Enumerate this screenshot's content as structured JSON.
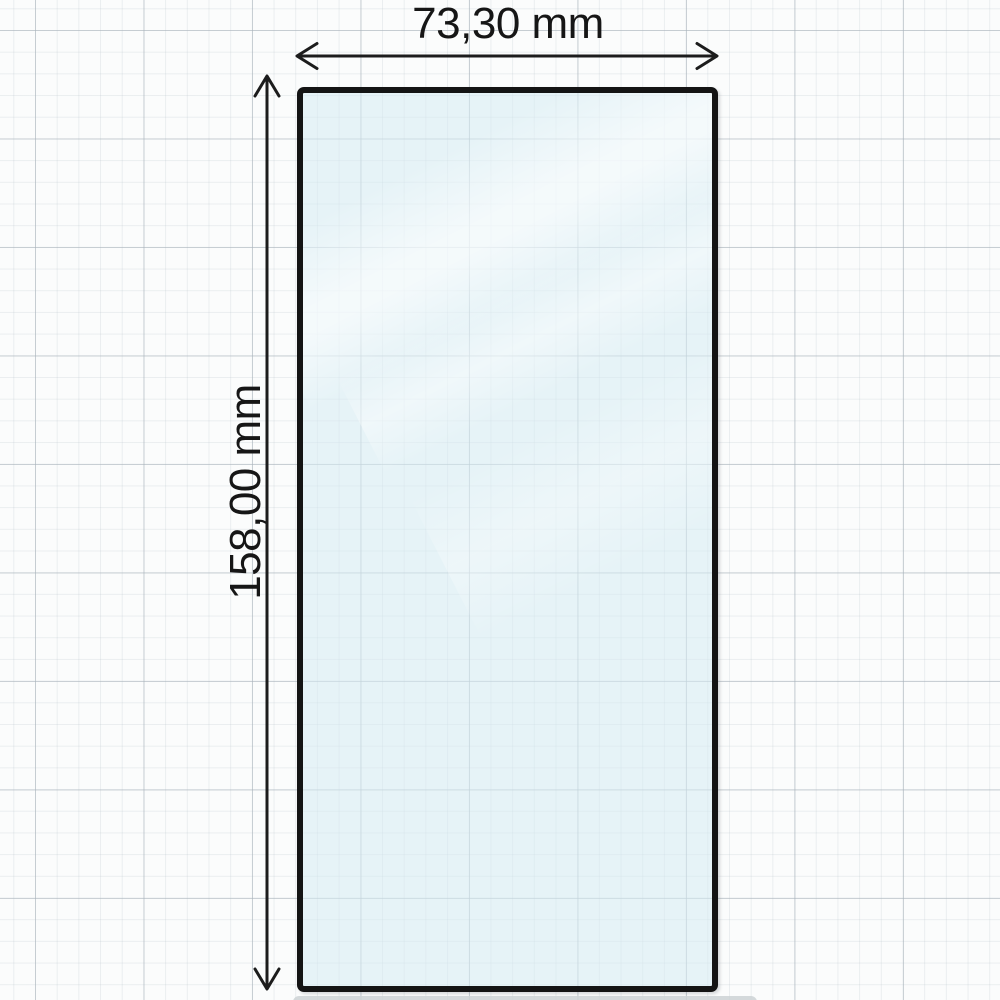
{
  "diagram": {
    "width_dimension": {
      "label": "73,30 mm"
    },
    "height_dimension": {
      "label": "158,00 mm"
    },
    "colors": {
      "background": "#fbfcfc",
      "grid_minor": "#e9edef",
      "grid_major": "#c8d0d6",
      "glass_fill": "#e7f2f6",
      "glass_border": "#141414",
      "dimension_line": "#1c1c1c",
      "label_text": "#161616"
    }
  }
}
